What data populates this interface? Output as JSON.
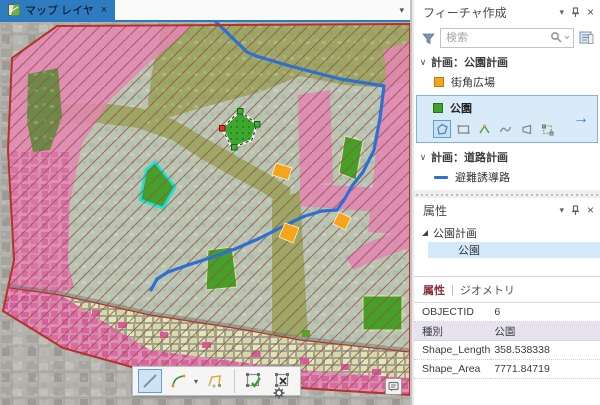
{
  "map": {
    "tab": {
      "title": "マップ レイヤ",
      "close_glyph": "×"
    },
    "tabbar_caret_glyph": "▾",
    "icons": [
      "map-thumbnail-icon",
      "map-notification-icon"
    ]
  },
  "create_features": {
    "title": "フィーチャ作成",
    "dock": {
      "caret_glyph": "▾",
      "close_glyph": "×",
      "icons": [
        "collapse-caret-icon",
        "pin-icon",
        "close-icon"
      ]
    },
    "search": {
      "placeholder": "検索",
      "icons": [
        "filter-funnel-icon",
        "magnifier-icon",
        "templates-pane-icon"
      ]
    },
    "sections": [
      {
        "label": "計画：公園計画",
        "expanded": true,
        "chevron_glyph": "∨"
      },
      {
        "label": "計画：道路計画",
        "expanded": true,
        "chevron_glyph": "∨"
      },
      {
        "label": "新防火帯",
        "expanded": false,
        "chevron_glyph": "›"
      }
    ],
    "templates": [
      {
        "label": "街角広場",
        "swatch_color": "#f5a41c"
      },
      {
        "label": "公園",
        "swatch_color": "#3fa22b",
        "selected": true
      }
    ],
    "tool_icons": [
      "polygon-tool-icon",
      "rectangle-tool-icon",
      "midpoint-tool-icon",
      "freehand-tool-icon",
      "shape-tool-icon",
      "edit-vertices-tool-icon"
    ],
    "card_arrow_glyph": "→",
    "road_template": {
      "label": "避難誘導路",
      "swatch_color": "#2e6fd0"
    }
  },
  "attributes_panel": {
    "title": "属性",
    "dock": {
      "caret_glyph": "▾",
      "close_glyph": "×"
    },
    "tree": {
      "parent": "公園計画",
      "child": "公園"
    },
    "tabs": {
      "active": "属性",
      "separator": "|",
      "inactive": "ジオメトリ"
    },
    "fields": [
      {
        "label": "OBJECTID",
        "value": "6"
      },
      {
        "label": "種別",
        "value": "公園"
      },
      {
        "label": "Shape_Length",
        "value": "358.538338"
      },
      {
        "label": "Shape_Area",
        "value": "7771.84719"
      }
    ]
  },
  "sketch_toolbar": {
    "tool_icons": [
      "line-segment-tool-icon",
      "arc-tool-icon",
      "trace-tool-icon",
      "finish-sketch-icon",
      "cancel-sketch-icon",
      "sketch-options-gear-icon"
    ],
    "arc_caret_glyph": "▾"
  },
  "colors": {
    "accent_blue": "#2e7cc0",
    "selection_fill": "#d9eaf8",
    "park_green": "#3fa22b",
    "plaza_orange": "#f5a41c",
    "route_blue": "#2d6fd2",
    "zone_pink": "#e287b3",
    "zone_sage": "#b9c5b3",
    "zone_olive": "#9aa45f",
    "hatch_red": "#9e4f46",
    "boundary_red": "#b4322a",
    "cyan_highlight": "#19e0d8"
  }
}
